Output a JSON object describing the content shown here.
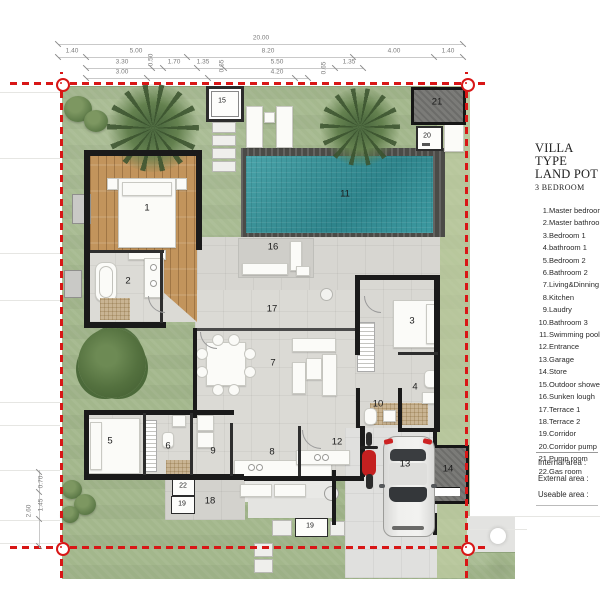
{
  "legend": {
    "title_line1": "VILLA TYPE",
    "title_line2": "LAND POT",
    "title_line3": "3 BEDROOM",
    "items": [
      {
        "num": "1",
        "label": "Master bedroom"
      },
      {
        "num": "2",
        "label": "Master bathroom"
      },
      {
        "num": "3",
        "label": "Bedroom 1"
      },
      {
        "num": "4",
        "label": "bathroom 1"
      },
      {
        "num": "5",
        "label": "Bedroom 2"
      },
      {
        "num": "6",
        "label": "Bathroom 2"
      },
      {
        "num": "7",
        "label": "Living&Dinning"
      },
      {
        "num": "8",
        "label": "Kitchen"
      },
      {
        "num": "9",
        "label": "Laudry"
      },
      {
        "num": "10",
        "label": "Bathroom 3"
      },
      {
        "num": "11",
        "label": "Swimming pool"
      },
      {
        "num": "12",
        "label": "Entrance"
      },
      {
        "num": "13",
        "label": "Garage"
      },
      {
        "num": "14",
        "label": "Store"
      },
      {
        "num": "15",
        "label": "Outdoor shower"
      },
      {
        "num": "16",
        "label": "Sunken lough"
      },
      {
        "num": "17",
        "label": "Terrace 1"
      },
      {
        "num": "18",
        "label": "Terrace 2"
      },
      {
        "num": "19",
        "label": "Corridor"
      },
      {
        "num": "20",
        "label": "Corridor pump"
      },
      {
        "num": "21",
        "label": "Pump room"
      },
      {
        "num": "22",
        "label": "Gas room"
      }
    ],
    "areas": [
      "Internal area :",
      "External area :",
      "Useable area :"
    ]
  },
  "plan": {
    "room_labels": [
      {
        "n": "1",
        "x": 147,
        "y": 208
      },
      {
        "n": "2",
        "x": 128,
        "y": 281
      },
      {
        "n": "3",
        "x": 412,
        "y": 321
      },
      {
        "n": "4",
        "x": 415,
        "y": 387
      },
      {
        "n": "5",
        "x": 110,
        "y": 441
      },
      {
        "n": "6",
        "x": 168,
        "y": 446
      },
      {
        "n": "7",
        "x": 273,
        "y": 363
      },
      {
        "n": "8",
        "x": 272,
        "y": 452
      },
      {
        "n": "9",
        "x": 213,
        "y": 451
      },
      {
        "n": "10",
        "x": 378,
        "y": 404
      },
      {
        "n": "11",
        "x": 345,
        "y": 194
      },
      {
        "n": "12",
        "x": 337,
        "y": 442
      },
      {
        "n": "13",
        "x": 405,
        "y": 464
      },
      {
        "n": "14",
        "x": 448,
        "y": 469
      },
      {
        "n": "15",
        "x": 222,
        "y": 101,
        "s": 1
      },
      {
        "n": "16",
        "x": 273,
        "y": 247
      },
      {
        "n": "17",
        "x": 272,
        "y": 309
      },
      {
        "n": "18",
        "x": 210,
        "y": 501
      },
      {
        "n": "19",
        "x": 182,
        "y": 504,
        "s": 1
      },
      {
        "n": "19",
        "x": 310,
        "y": 526,
        "s": 1
      },
      {
        "n": "20",
        "x": 427,
        "y": 136,
        "s": 1
      },
      {
        "n": "21",
        "x": 437,
        "y": 102
      },
      {
        "n": "22",
        "x": 183,
        "y": 486,
        "s": 1
      }
    ]
  },
  "dimensions": {
    "top": [
      {
        "v": "20.00",
        "x": 261,
        "y": 38
      },
      {
        "v": "1.40",
        "x": 72,
        "y": 51
      },
      {
        "v": "5.00",
        "x": 136,
        "y": 51
      },
      {
        "v": "8.20",
        "x": 268,
        "y": 51
      },
      {
        "v": "4.00",
        "x": 394,
        "y": 51
      },
      {
        "v": "1.40",
        "x": 448,
        "y": 51
      },
      {
        "v": "3.30",
        "x": 122,
        "y": 62
      },
      {
        "v": "0.50",
        "x": 151,
        "y": 60,
        "r": 1
      },
      {
        "v": "1.70",
        "x": 174,
        "y": 62
      },
      {
        "v": "1.35",
        "x": 203,
        "y": 62
      },
      {
        "v": "5.50",
        "x": 277,
        "y": 62
      },
      {
        "v": "1.35",
        "x": 349,
        "y": 62
      },
      {
        "v": "3.00",
        "x": 122,
        "y": 72
      },
      {
        "v": "0.65",
        "x": 222,
        "y": 66,
        "r": 1
      },
      {
        "v": "4.20",
        "x": 277,
        "y": 72
      },
      {
        "v": "0.65",
        "x": 324,
        "y": 68,
        "r": 1
      }
    ],
    "left": [
      {
        "v": "0.70",
        "x": 41,
        "y": 482,
        "r": 1
      },
      {
        "v": "1.45",
        "x": 41,
        "y": 505,
        "r": 1
      },
      {
        "v": "2.60",
        "x": 29,
        "y": 511,
        "r": 1
      }
    ]
  },
  "colors": {
    "boundary_red": "#d81616",
    "pool_water": "#3a949b",
    "grass": "#a3b78c",
    "wood_floor": "#c2945c",
    "wall_black": "#1a1a1a",
    "floor_gray": "#d9d8d3"
  }
}
